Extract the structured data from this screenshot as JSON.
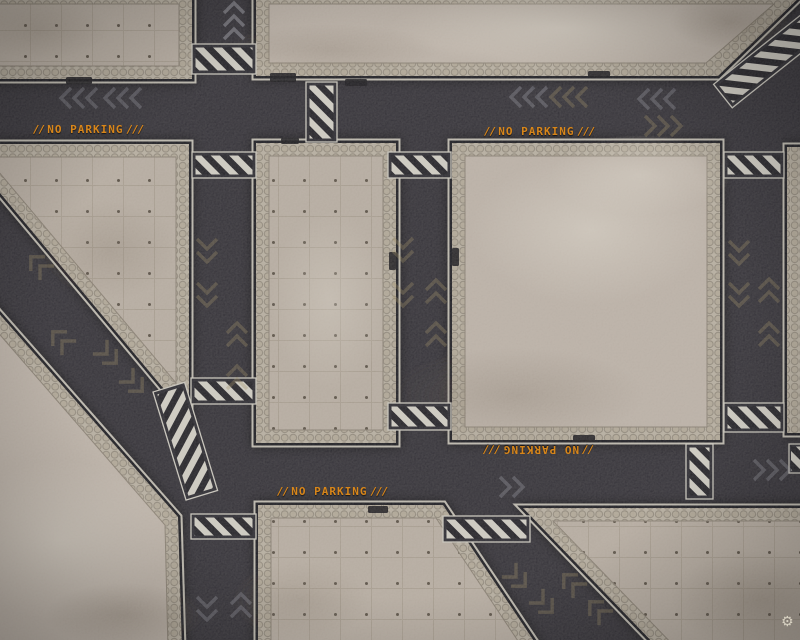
{
  "mat": {
    "labels": {
      "no_parking": {
        "prefix": "//",
        "text": "NO PARKING",
        "suffix": "///"
      }
    },
    "watermark": {
      "icon": "gear",
      "glyph": "⚙"
    },
    "colors": {
      "asphalt": "#2d2b32",
      "concrete_light": "#b8aea4",
      "hex_border": "#b1a89a",
      "hazard_stripe_light": "#ccc9c0",
      "hazard_stripe_dark": "#1d1c22",
      "warning_orange": "#d8861a",
      "chevron_gray": "#a4a5b1",
      "chevron_olive": "#9c8a5e"
    }
  }
}
